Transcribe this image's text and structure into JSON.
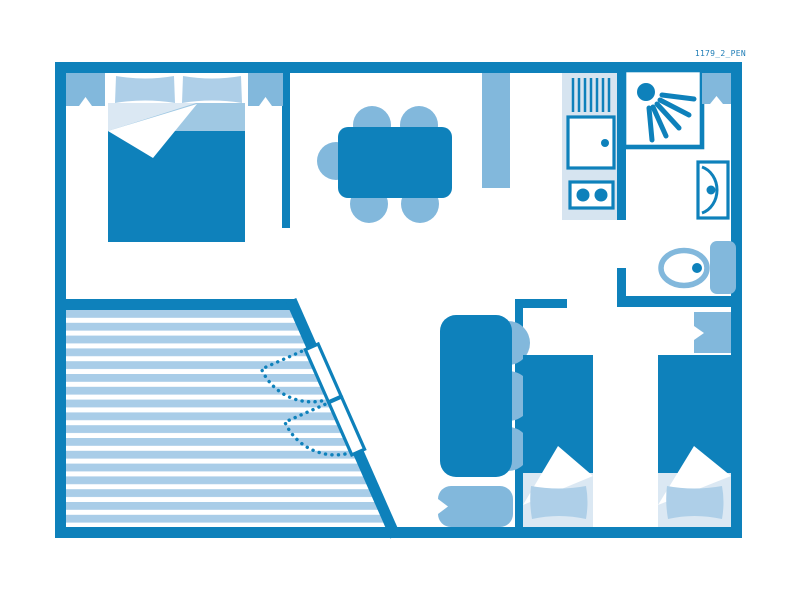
{
  "plan": {
    "code_label": "1179_2_PEN",
    "type": "floor-plan",
    "rooms": [
      {
        "name": "bedroom-double",
        "items": [
          "window",
          "double-bed",
          "window"
        ]
      },
      {
        "name": "living-dining",
        "items": [
          "dining-table",
          "chair",
          "chair",
          "chair",
          "chair",
          "chair",
          "partition-screen"
        ]
      },
      {
        "name": "kitchen",
        "items": [
          "sink-drainer",
          "kitchen-unit",
          "hob-two-burners"
        ]
      },
      {
        "name": "bathroom",
        "items": [
          "shower-cabin",
          "window",
          "washbasin",
          "toilet"
        ]
      },
      {
        "name": "lounge",
        "items": [
          "sofa",
          "bolster-cushion"
        ]
      },
      {
        "name": "bedroom-twin",
        "items": [
          "single-bed",
          "single-bed",
          "window"
        ]
      },
      {
        "name": "terrace",
        "items": [
          "decking-stripes",
          "french-door",
          "french-door"
        ]
      }
    ]
  },
  "colors": {
    "primary": "#0e81bb",
    "mid": "#82b8dc",
    "pillow": "#aecfe8",
    "band": "#9fc8e3",
    "pale": "#dbe8f3",
    "panel": "#d6e4f0",
    "stripe": "#a9cde8",
    "label": "#1f7db6"
  }
}
